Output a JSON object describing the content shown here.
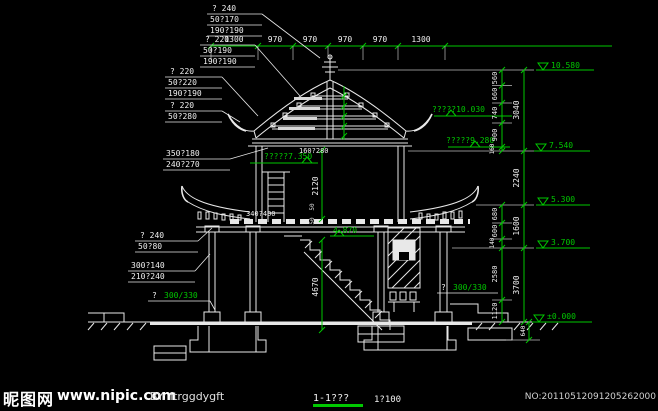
{
  "colors": {
    "background": "#000000",
    "linework": "#e8e8e8",
    "dimension_green": "#00c800"
  },
  "top_dims": [
    "1300",
    "970",
    "970",
    "970",
    "970",
    "1300"
  ],
  "left_labels": [
    [
      "? 240",
      "50?170",
      "190?190"
    ],
    [
      "? 220",
      "50?190",
      "190?190"
    ],
    [
      "? 220",
      "50?220",
      "190?190"
    ],
    [
      "? 220",
      "50?280"
    ],
    [
      "350?180",
      "240?270"
    ],
    [
      "? 240",
      "50?80"
    ],
    [
      "300?140",
      "210?240"
    ]
  ],
  "piles": {
    "left": {
      "prefix": "?",
      "value": "300/330"
    },
    "right": {
      "prefix": "?",
      "value": "300/330"
    }
  },
  "annotations": {
    "ridge_elev": "?????10.030",
    "eave_elev": "?????9.280",
    "floor2_elev": "?????7.350",
    "beam_a": "160?280",
    "beam_b": "340?400",
    "stair_elev": "4.870"
  },
  "mid_dims": {
    "upper": "2120",
    "lower": "4670",
    "gap_a": "50",
    "gap_b": "50",
    "plinth": "640"
  },
  "right_dims": {
    "inner_top": [
      "560",
      "660",
      "740",
      "900",
      "160"
    ],
    "outer_top": [
      "3040",
      "2240"
    ],
    "inner_mid": [
      "680",
      "600",
      "140"
    ],
    "outer_mid": [
      "1600",
      "3700"
    ],
    "inner_bottom": [
      "2580",
      "1120"
    ]
  },
  "elevations": [
    "10.580",
    "7.540",
    "5.300",
    "3.700",
    "±0.000"
  ],
  "title_block": {
    "title": "1-1???",
    "scale": "1?100"
  },
  "watermark": {
    "site_name": "昵图网",
    "site_url": "www.nipic.com",
    "author": "BY: ftrggdygft",
    "serial": "NO:20110512091205262000"
  }
}
